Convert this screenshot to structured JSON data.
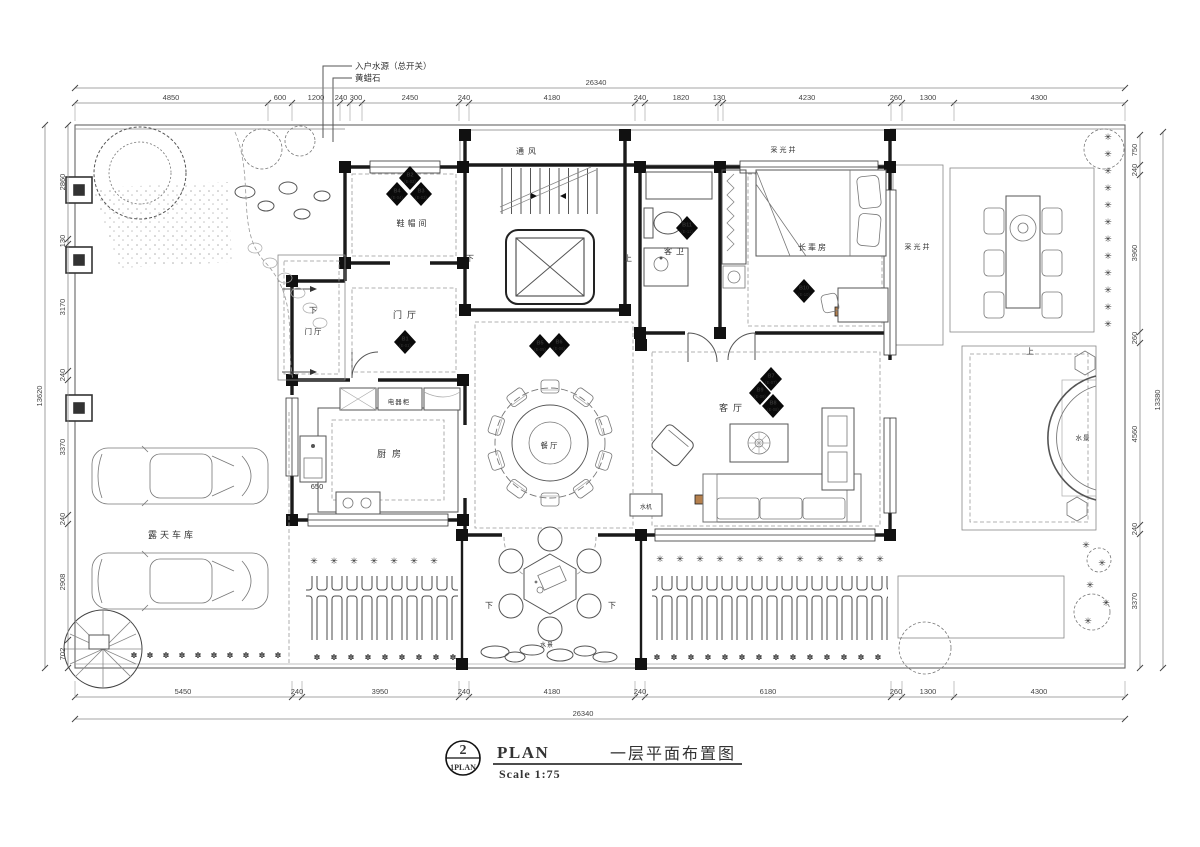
{
  "title_block": {
    "detail_number": "2",
    "detail_ref": "1PLAN",
    "title_en": "PLAN",
    "scale": "Scale 1:75",
    "title_cn": "一层平面布置图"
  },
  "labels": [
    {
      "id": "room-shoe",
      "t": "鞋帽间"
    },
    {
      "id": "room-entry-hall",
      "t": "门厅"
    },
    {
      "id": "room-entry-hall-2",
      "t": "门厅"
    },
    {
      "id": "room-kitchen",
      "t": "厨房"
    },
    {
      "id": "cabinet-appliance",
      "t": "电器柜"
    },
    {
      "id": "room-dining",
      "t": "餐厅"
    },
    {
      "id": "room-living",
      "t": "客厅"
    },
    {
      "id": "room-guest-bath",
      "t": "客卫"
    },
    {
      "id": "room-elder-bedroom",
      "t": "长辈房"
    },
    {
      "id": "shaft-vent",
      "t": "通风"
    },
    {
      "id": "light-well-top",
      "t": "采光井"
    },
    {
      "id": "light-well-right",
      "t": "采光井"
    },
    {
      "id": "room-carport",
      "t": "露天车库"
    },
    {
      "id": "water-feature-bottom",
      "t": "水景"
    },
    {
      "id": "water-feature-right",
      "t": "水景"
    },
    {
      "id": "water-machine",
      "t": "水机"
    },
    {
      "id": "dim-kitchen-650",
      "t": "650"
    },
    {
      "id": "stair-up",
      "t": "上"
    },
    {
      "id": "stair-down",
      "t": "下"
    },
    {
      "id": "step-down-porch",
      "t": "下"
    },
    {
      "id": "step-down-terrace-left",
      "t": "下"
    },
    {
      "id": "step-down-terrace-right",
      "t": "下"
    },
    {
      "id": "step-up-right-garden",
      "t": "上"
    },
    {
      "id": "annotation-water-source",
      "t": "入户水源（总开关）"
    },
    {
      "id": "annotation-yellow-wax-stone",
      "t": "黄蜡石"
    }
  ],
  "markers": [
    {
      "code": "B1",
      "ref": "(E-01)"
    },
    {
      "code": "B2",
      "ref": "(E-02)"
    },
    {
      "code": "B3",
      "ref": "(E-03)"
    },
    {
      "code": "B4",
      "ref": "(E-04)"
    },
    {
      "code": "B5",
      "ref": "(E-05)"
    },
    {
      "code": "B6",
      "ref": "(E-06)"
    },
    {
      "code": "B7",
      "ref": "(E-07)"
    },
    {
      "code": "B8",
      "ref": "(E-08)"
    },
    {
      "code": "B9",
      "ref": "(E-09)"
    },
    {
      "code": "B10",
      "ref": "(E-10)"
    },
    {
      "code": "B11",
      "ref": "(E-11)"
    }
  ],
  "dimensions": {
    "top": [
      "4850",
      "600",
      "1200",
      "240",
      "300",
      "2450",
      "240",
      "4180",
      "240",
      "1820",
      "130",
      "4230",
      "260",
      "1300",
      "4300"
    ],
    "top_total": "26340",
    "bottom": [
      "5450",
      "240",
      "3950",
      "240",
      "4180",
      "240",
      "6180",
      "260",
      "1300",
      "4300"
    ],
    "bottom_total": "26340",
    "left": [
      "2860",
      "130",
      "3170",
      "240",
      "3370",
      "240",
      "2908",
      "702"
    ],
    "left_total": "13620",
    "right": [
      "750",
      "240",
      "3960",
      "260",
      "4560",
      "240",
      "3370"
    ],
    "right_total": "13380"
  }
}
